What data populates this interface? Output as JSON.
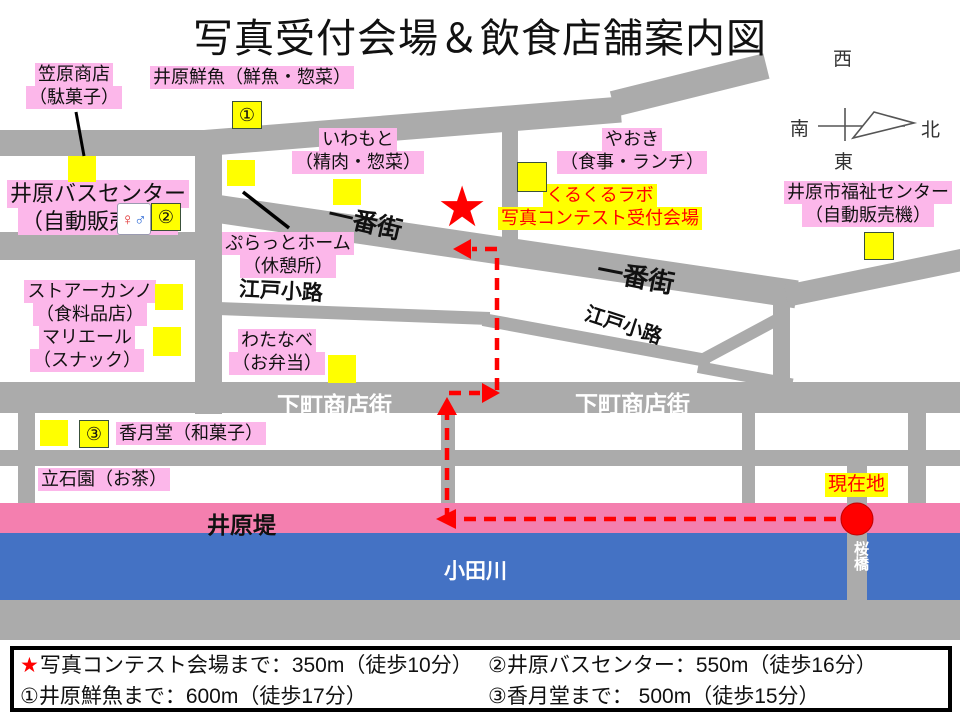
{
  "title": "写真受付会場＆飲食店舗案内図",
  "compass": {
    "west": "西",
    "south": "南",
    "north": "北",
    "east": "東"
  },
  "roads": {
    "ichibangai": "一番街",
    "edokoji": "江戸小路",
    "shitamachi": "下町商店街"
  },
  "waterfront": {
    "embankment": "井原堤",
    "river": "小田川",
    "bridge": "桜橋"
  },
  "current_location": "現在地",
  "venue": {
    "line1": "くるくるラボ",
    "line2": "写真コンテスト受付会場"
  },
  "markers": {
    "no1": "①",
    "no2": "②",
    "no3": "③",
    "star": "★",
    "toilet_female": "♀",
    "toilet_male": "♂"
  },
  "places": {
    "kasahara": {
      "line1": "笠原商店",
      "line2": "（駄菓子）"
    },
    "ihara_sengyo": {
      "line1": "井原鮮魚（鮮魚・惣菜）"
    },
    "iwamoto": {
      "line1": "いわもと",
      "line2": "（精肉・惣菜）"
    },
    "yaoki": {
      "line1": "やおき",
      "line2": "（食事・ランチ）"
    },
    "bus_center": {
      "line1": "井原バスセンター",
      "line2": "（自動販売機）"
    },
    "fukushi_center": {
      "line1": "井原市福祉センター",
      "line2": "（自動販売機）"
    },
    "puratto_home": {
      "line1": "ぷらっとホーム",
      "line2": "（休憩所）"
    },
    "store_kanno": {
      "line1": "ストアーカンノ",
      "line2": "（食料品店）"
    },
    "mariere": {
      "line1": "マリエール",
      "line2": "（スナック）"
    },
    "watanabe": {
      "line1": "わたなべ",
      "line2": "（お弁当）"
    },
    "kagetsudo": {
      "line1": "香月堂（和菓子）"
    },
    "tateishien": {
      "line1": "立石園（お茶）"
    }
  },
  "legend": {
    "row1_col1_star": "★",
    "row1_col1": "写真コンテスト会場まで：350m（徒歩10分）",
    "row1_col2": "②井原バスセンター：550m（徒歩16分）",
    "row2_col1": "①井原鮮魚まで：600m（徒歩17分）",
    "row2_col2": "③香月堂まで： 500m（徒歩15分）"
  },
  "colors": {
    "road_gray": "#ABABAB",
    "label_pink": "#FCB7EA",
    "highlight_yellow": "#FFFF00",
    "embankment_pink": "#F47FAF",
    "river_blue": "#4472C4",
    "route_red": "#FF0000"
  }
}
